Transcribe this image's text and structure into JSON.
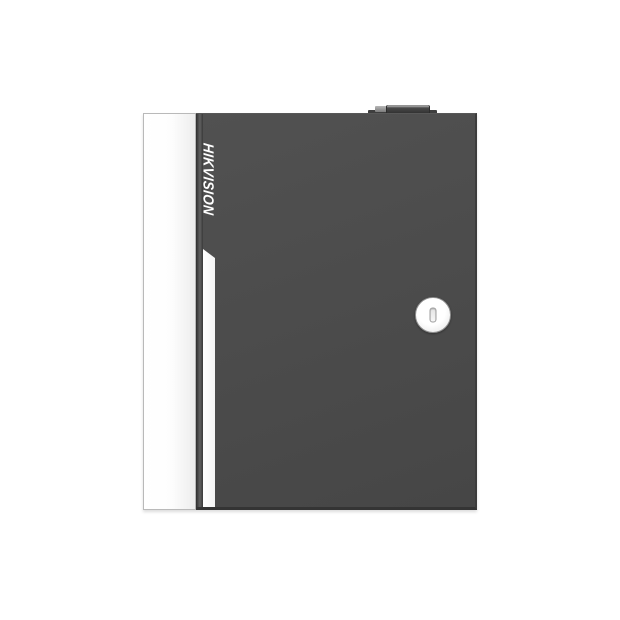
{
  "page": {
    "background": "#ffffff"
  },
  "device": {
    "brand_label": "HIKVISION",
    "colors": {
      "door_gray": "#4b4b4b",
      "door_edge_dark": "#343434",
      "side_panel_white": "#fdfdfd",
      "panel_border_gray": "#b9b9b9",
      "accent_stripe_white": "#ffffff",
      "logo_text_white": "#ffffff",
      "lock_ring_gray": "#8f8f8f",
      "lock_face_white": "#f7f7f7",
      "knob_dark": "#303030",
      "knob_highlight": "#949494"
    },
    "icons": {
      "lock": "keyhole-icon",
      "top_fitting": "hinge-knob-icon"
    }
  }
}
